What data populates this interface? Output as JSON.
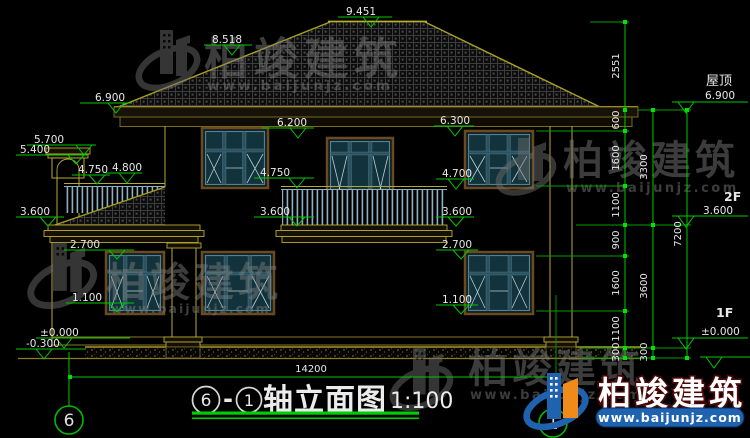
{
  "title": {
    "bubble_left": "6",
    "separator": "-",
    "bubble_right": "1",
    "name": "轴立面图",
    "scale": "1:100"
  },
  "axes": {
    "left": "6",
    "bottom": "1"
  },
  "levels": {
    "ridge": "9.451",
    "roof_break": "8.518",
    "eave": "6.900",
    "chimney_top": "5.700",
    "chimney_cap": "5.400",
    "porch_rail_left": "4.750",
    "porch_rail_right": "4.800",
    "porch_eave": "3.600",
    "balcony_door_top": "6.200",
    "window2_top": "6.300",
    "balcony_rail": "4.750",
    "balcony_floor": "3.600",
    "window2_sill": "4.700",
    "floor2_right": "3.600",
    "window1_top_left": "2.700",
    "window1_sill_left": "1.100",
    "window1_top_right": "2.700",
    "window1_sill_right": "1.100",
    "ground": "±0.000",
    "grade": "-0.300"
  },
  "right_marks": {
    "roof_label": "屋顶",
    "roof_value": "6.900",
    "f2_label": "2F",
    "f2_value": "3.600",
    "f1_label": "1F",
    "f1_value": "±0.000"
  },
  "dims": {
    "chain_inner": [
      "2551",
      "600",
      "1600",
      "1100",
      "900",
      "1600",
      "1100",
      "300"
    ],
    "chain_middle": [
      "3300",
      "3600",
      "300"
    ],
    "chain_outer": [
      "7200"
    ],
    "total_width": "14200"
  },
  "watermark": {
    "name": "柏竣建筑",
    "url": "www.baijunjz.com"
  },
  "colors": {
    "background": "#000000",
    "dim_green": "#00c800",
    "line_yellow": "#b8a832",
    "glass_teal": "#12333c",
    "frame_steel": "#54808f",
    "watermark_gray": "#7d7d7d",
    "logo_blue": "#1f63b0",
    "logo_orange": "#f08a1a"
  }
}
